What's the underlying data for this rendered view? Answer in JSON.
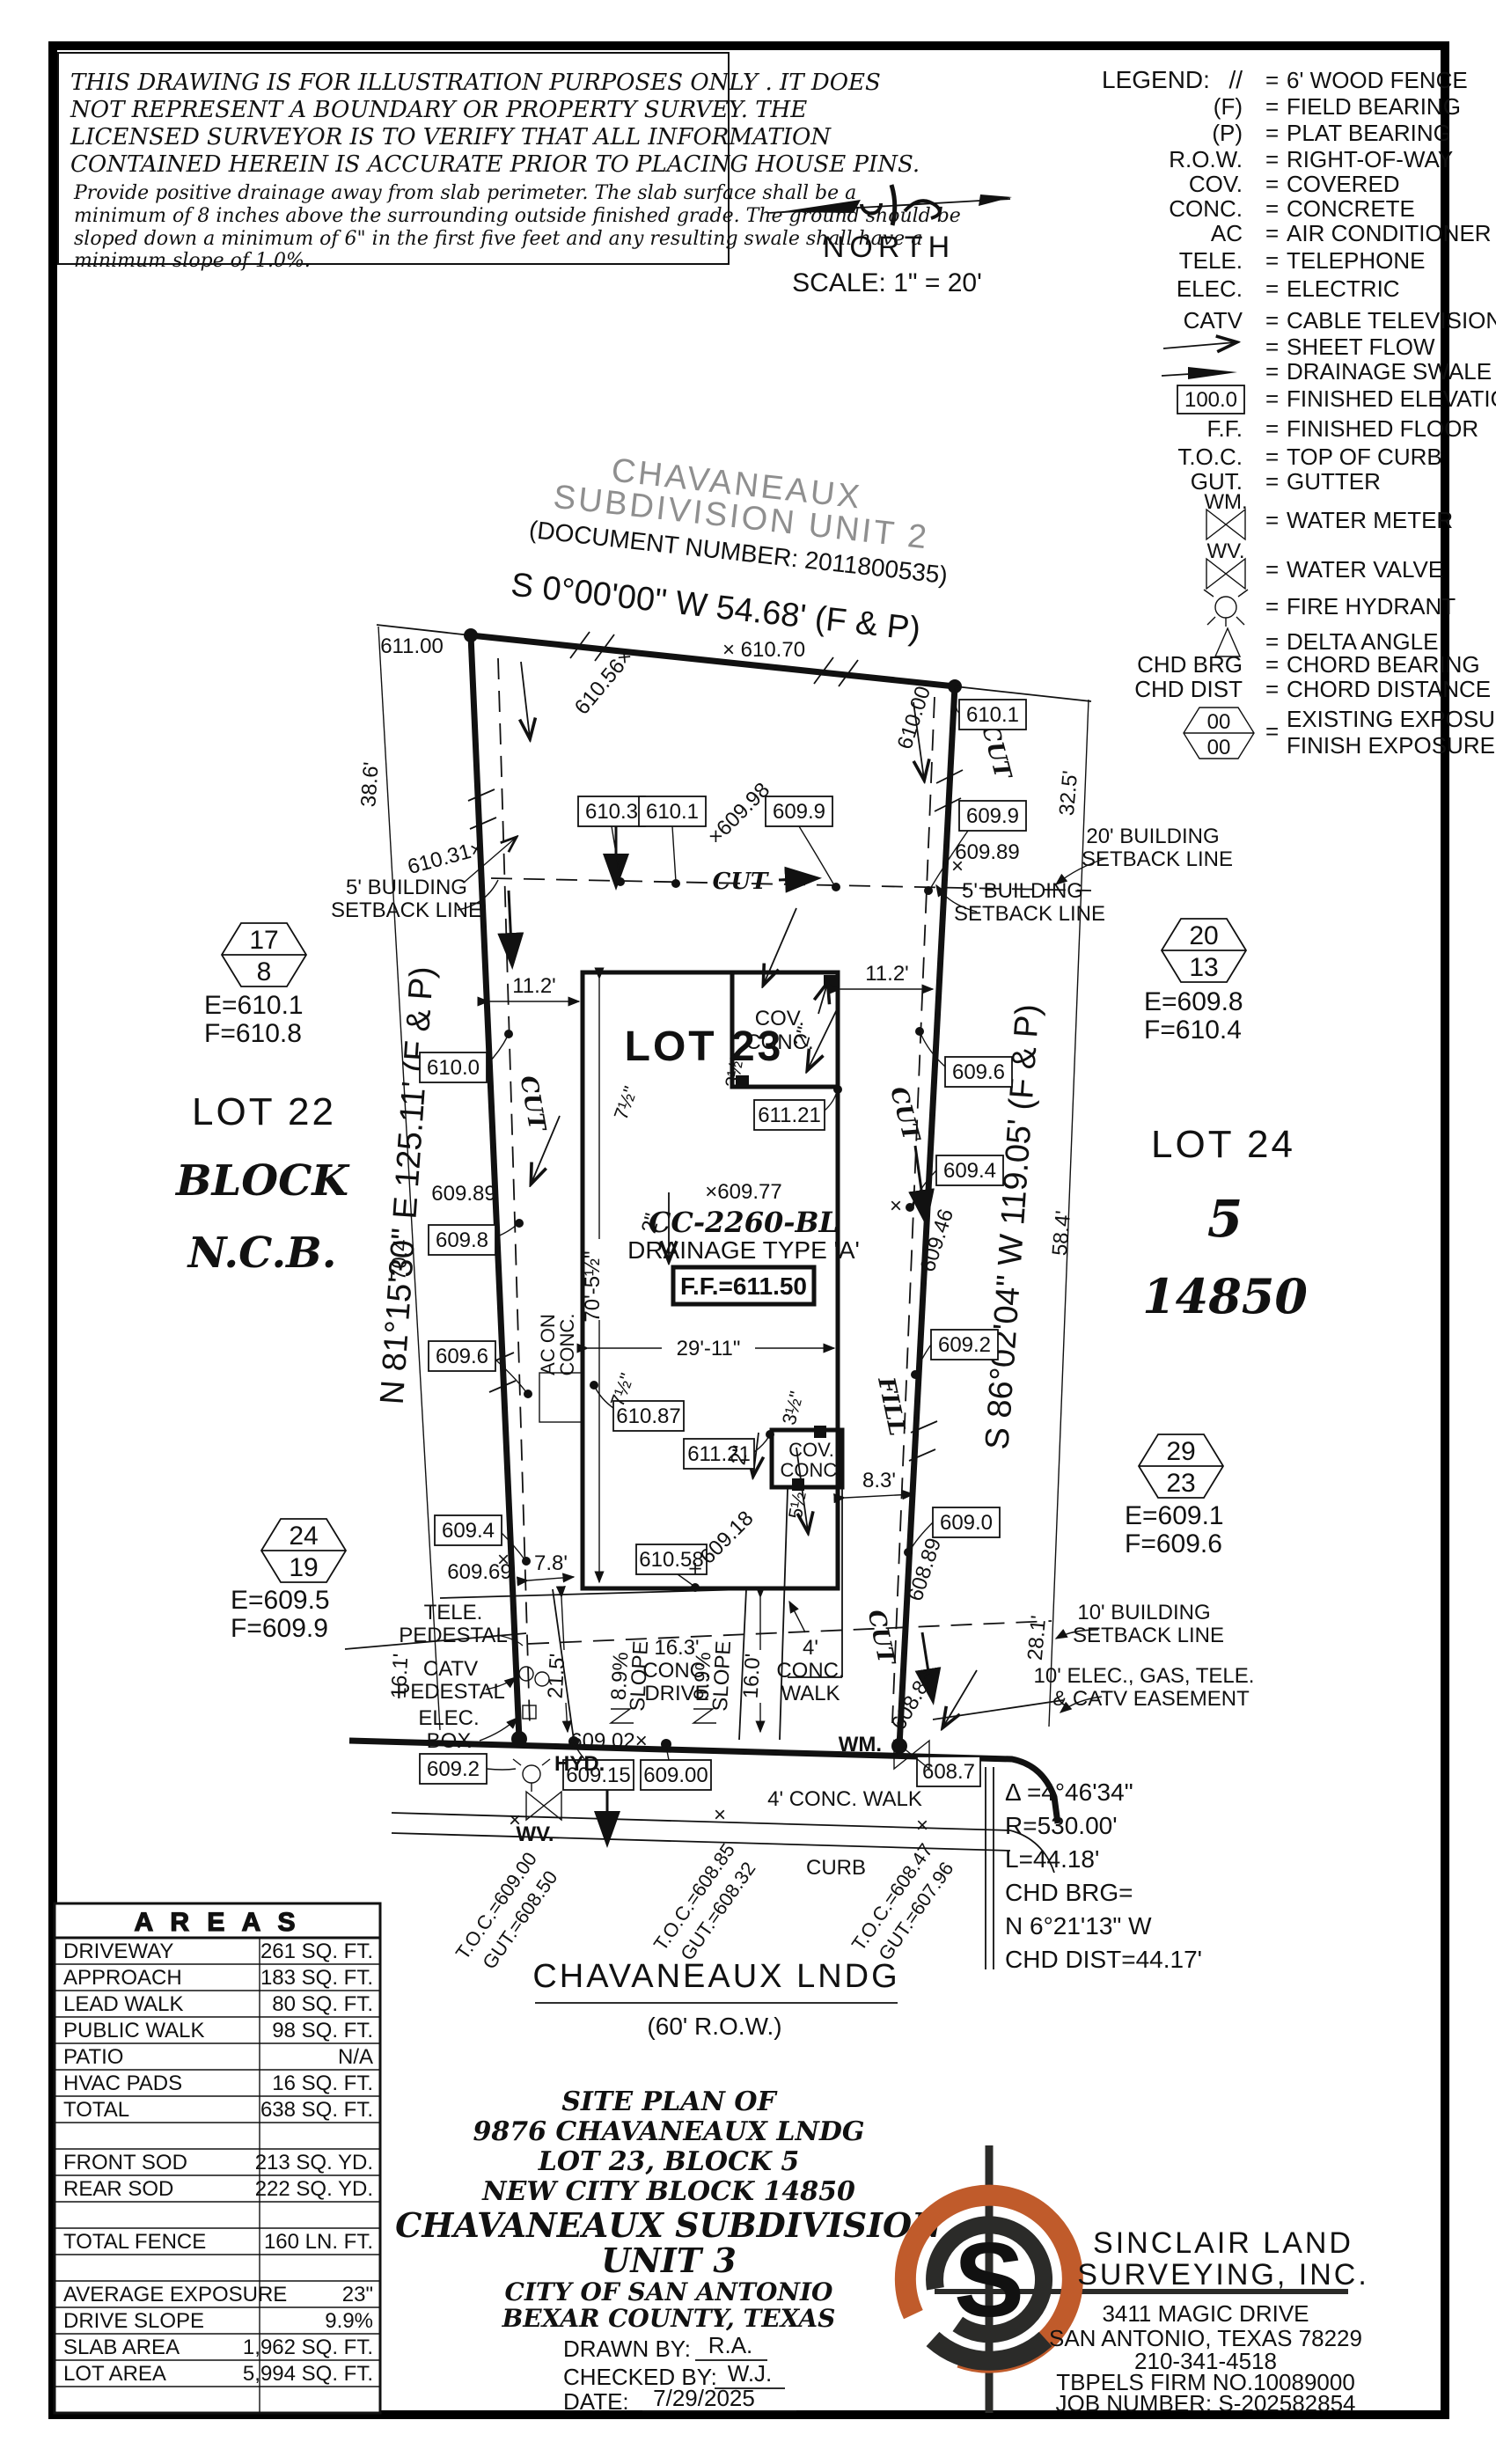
{
  "disclaimer": {
    "lines": [
      "THIS DRAWING IS FOR ILLUSTRATION PURPOSES ONLY . IT DOES",
      "NOT REPRESENT A BOUNDARY OR PROPERTY SURVEY. THE",
      "LICENSED SURVEYOR IS TO VERIFY THAT ALL INFORMATION",
      "CONTAINED HEREIN IS ACCURATE PRIOR TO PLACING HOUSE PINS.",
      "Provide positive drainage away from slab perimeter. The slab surface shall be a",
      "minimum of 8 inches above the surrounding outside finished grade. The ground should be",
      "sloped down a minimum of 6\" in the first five feet and any resulting swale shall have a",
      "minimum slope of 1.0%."
    ]
  },
  "north": {
    "label": "NORTH",
    "scale": "SCALE:  1\" =  20'"
  },
  "legend": {
    "title": "LEGEND:",
    "eq": "=",
    "rows": [
      {
        "sym": "//",
        "desc": "6' WOOD FENCE"
      },
      {
        "sym": "(F)",
        "desc": "FIELD BEARING"
      },
      {
        "sym": "(P)",
        "desc": "PLAT BEARING"
      },
      {
        "sym": "R.O.W.",
        "desc": "RIGHT-OF-WAY"
      },
      {
        "sym": "COV.",
        "desc": "COVERED"
      },
      {
        "sym": "CONC.",
        "desc": "CONCRETE"
      },
      {
        "sym": "AC",
        "desc": "AIR CONDITIONER"
      },
      {
        "sym": "TELE.",
        "desc": "TELEPHONE"
      },
      {
        "sym": "ELEC.",
        "desc": "ELECTRIC"
      },
      {
        "sym": "CATV",
        "desc": "CABLE TELEVISION"
      },
      {
        "sym": "",
        "desc": "SHEET FLOW"
      },
      {
        "sym": "",
        "desc": "DRAINAGE SWALE"
      },
      {
        "sym": "100.0",
        "desc": "FINISHED ELEVATION"
      },
      {
        "sym": "F.F.",
        "desc": "FINISHED FLOOR"
      },
      {
        "sym": "T.O.C.",
        "desc": "TOP OF CURB"
      },
      {
        "sym": "GUT.",
        "desc": "GUTTER"
      },
      {
        "sym": "WM.",
        "desc": "WATER METER"
      },
      {
        "sym": "WV.",
        "desc": "WATER VALVE"
      },
      {
        "sym": "",
        "desc": "FIRE HYDRANT"
      },
      {
        "sym": "",
        "desc": "DELTA ANGLE"
      },
      {
        "sym": "CHD BRG",
        "desc": "CHORD BEARING"
      },
      {
        "sym": "CHD DIST",
        "desc": "CHORD DISTANCE"
      },
      {
        "sym": "00",
        "sym2": "00",
        "desc": "EXISTING EXPOSURE",
        "desc2": "FINISH EXPOSURE"
      }
    ]
  },
  "sub": {
    "name1": "CHAVANEAUX",
    "name2": "SUBDIVISION  UNIT  2",
    "doc": "(DOCUMENT NUMBER:  2011800535)",
    "bearing": "S 0°00'00\" W 54.68' (F & P)"
  },
  "plot": {
    "lot23": "LOT 23",
    "lot22": "LOT 22",
    "block": "BLOCK",
    "ncb": "N.C.B.",
    "lot24": "LOT 24",
    "five": "5",
    "ncb_num": "14850",
    "bearing_left": "N 81°15'30\" E 125.11' (F & P)",
    "bearing_right": "S 86°02'04\" W 119.05' (F & P)",
    "spot97": "×609.77",
    "cc": "CC-2260-BL",
    "drainage": "DRAINAGE  TYPE  'A'",
    "ff": "F.F.=611.50"
  },
  "dims": {
    "d611": "611.00",
    "d38": "38.6'",
    "d70": "70.4'",
    "d16_1": "16.1'",
    "d11": "11.2'",
    "d32": "32.5'",
    "d58": "58.4'",
    "d28": "28.1'",
    "d78": "7.8'",
    "d83": "8.3'",
    "d215": "21.5'",
    "d160": "16.0'",
    "h70": "70'-5½\"",
    "h29": "29'-11\""
  },
  "elev": {
    "e610_0": "610.0",
    "e609_8": "609.8",
    "e609_6": "609.6",
    "e609_4": "609.4",
    "e610_3": "610.3",
    "e610_1": "610.1",
    "e609_9": "609.9",
    "e609_2": "609.2",
    "e609_0": "609.0",
    "e610_87": "610.87",
    "e611_21": "611.21",
    "e610_58": "610.58",
    "e609_15": "609.15",
    "e609_00": "609.00",
    "e608_7": "608.7",
    "e100": "100.0"
  },
  "spots": {
    "s610_56": "610.56×",
    "s610_70": "× 610.70",
    "s610_00": "610.00",
    "s609_98": "×609.98",
    "s609_89": "609.89",
    "s610_31": "610.31×",
    "s609_46": "609.46",
    "s609_69": "609.69",
    "s609_18": "× 609.18",
    "s608_89": "608.89",
    "s608_83": "608.83",
    "s609_02": "609.02×"
  },
  "sb": {
    "b5a": "5' BUILDING",
    "sbl": "SETBACK LINE",
    "b20a": "20' BUILDING",
    "b10a": "10' BUILDING",
    "esmt1": "10' ELEC., GAS, TELE.",
    "esmt2": "& CATV EASEMENT"
  },
  "util": {
    "tele": "TELE.",
    "ped": "PEDESTAL",
    "catv": "CATV",
    "elec": "ELEC.",
    "boxw": "BOX",
    "hyd": "HYD.",
    "wv": "WV.",
    "wm": "WM."
  },
  "flow": {
    "cut": "CUT",
    "fill": "FILL"
  },
  "cov": {
    "a": "COV.",
    "b": "CONC."
  },
  "ac": {
    "a": "AC ON"
  },
  "drv": {
    "a": "16.3'",
    "c": "DRIVE"
  },
  "wk": {
    "a": "4'",
    "c": "WALK"
  },
  "st": {
    "walk": "4' CONC. WALK",
    "curb": "CURB"
  },
  "slope": {
    "a": "8.9%",
    "b": "SLOPE",
    "c": "9.9%"
  },
  "frac": {
    "two": "2\"",
    "three": "3½\"",
    "five": "5½\"",
    "seven": "7½\""
  },
  "toc": {
    "a1": "T.O.C.=609.00",
    "a2": "GUT.=608.50",
    "b1": "T.O.C.=608.85",
    "b2": "GUT.=608.32",
    "c1": "T.O.C.=608.47",
    "c2": "GUT.=607.96"
  },
  "hex": {
    "zero": "00",
    "h1": {
      "top": "17",
      "bot": "8",
      "e": "E=610.1",
      "f": "F=610.8"
    },
    "h2": {
      "top": "24",
      "bot": "19",
      "e": "E=609.5",
      "f": "F=609.9"
    },
    "h3": {
      "top": "20",
      "bot": "13",
      "e": "E=609.8",
      "f": "F=610.4"
    },
    "h4": {
      "top": "29",
      "bot": "23",
      "e": "E=609.1",
      "f": "F=609.6"
    }
  },
  "curve": {
    "l1": "Δ =4°46'34\"",
    "l2": "R=530.00'",
    "l3": "L=44.18'",
    "l4": "CHD BRG=",
    "l5": "N 6°21'13\" W",
    "l6": "CHD DIST=44.17'"
  },
  "street": {
    "name": "CHAVANEAUX  LNDG",
    "row": "(60' R.O.W.)"
  },
  "tb": {
    "l1": "SITE  PLAN  OF",
    "l2": "9876  CHAVANEAUX  LNDG",
    "l3": "LOT  23,  BLOCK  5",
    "l4": "NEW  CITY  BLOCK  14850",
    "l5": "CHAVANEAUX  SUBDIVISION",
    "l6": "UNIT  3",
    "l7": "CITY  OF  SAN  ANTONIO",
    "l8": "BEXAR  COUNTY,  TEXAS",
    "drawn_label": "DRAWN  BY:",
    "drawn": "R.A.",
    "checked_label": "CHECKED  BY:",
    "checked": "W.J.",
    "date_label": "DATE:",
    "date": "7/29/2025"
  },
  "areas": {
    "title": "A R E A S",
    "rows": [
      {
        "label": "DRIVEWAY",
        "value": "261 SQ. FT."
      },
      {
        "label": "APPROACH",
        "value": "183 SQ. FT."
      },
      {
        "label": "LEAD WALK",
        "value": "80 SQ. FT."
      },
      {
        "label": "PUBLIC WALK",
        "value": "98 SQ. FT."
      },
      {
        "label": "PATIO",
        "value": "N/A"
      },
      {
        "label": "HVAC PADS",
        "value": "16 SQ. FT."
      },
      {
        "label": "TOTAL",
        "value": "638 SQ. FT."
      },
      {
        "label": "",
        "value": ""
      },
      {
        "label": "FRONT SOD",
        "value": "213 SQ. YD."
      },
      {
        "label": "REAR SOD",
        "value": "222 SQ. YD."
      },
      {
        "label": "",
        "value": ""
      },
      {
        "label": "TOTAL FENCE",
        "value": "160  LN. FT."
      },
      {
        "label": "",
        "value": ""
      },
      {
        "label": "AVERAGE EXPOSURE",
        "value": "23\""
      },
      {
        "label": "DRIVE SLOPE",
        "value": "9.9%"
      },
      {
        "label": "SLAB AREA",
        "value": "1,962 SQ. FT."
      },
      {
        "label": "LOT AREA",
        "value": "5,994 SQ. FT."
      },
      {
        "label": "",
        "value": ""
      }
    ]
  },
  "firm": {
    "name1": "SINCLAIR  LAND",
    "name2": "SURVEYING,  INC.",
    "addr1": "3411  MAGIC  DRIVE",
    "addr2": "SAN  ANTONIO,  TEXAS  78229",
    "phone": "210-341-4518",
    "reg": "TBPELS  FIRM  NO.10089000",
    "job": "JOB  NUMBER: S-202582854"
  },
  "colors": {
    "accent": "#C05B2B",
    "ink": "#111111",
    "gray": "#8f8f8f"
  }
}
